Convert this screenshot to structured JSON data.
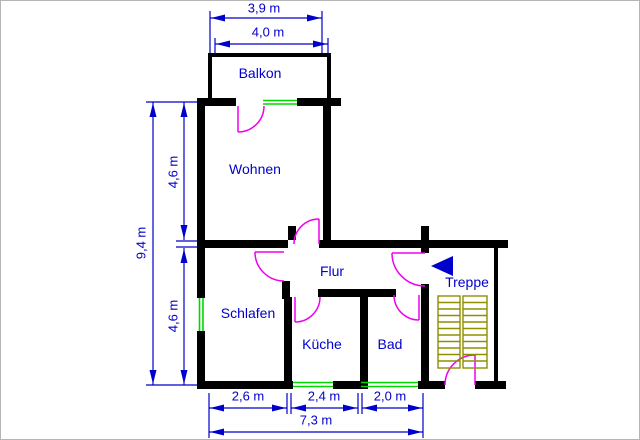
{
  "title": "Wohnungsgrundriss",
  "rooms": {
    "balcony": "Balkon",
    "living": "Wohnen",
    "hall": "Flur",
    "bedroom": "Schlafen",
    "kitchen": "Küche",
    "bath": "Bad",
    "stairs": "Treppe"
  },
  "dimensions": {
    "balcony_width": "3,9 m",
    "living_width": "4,0 m",
    "total_height": "9,4 m",
    "living_height": "4,6 m",
    "bedroom_height": "4,6 m",
    "bedroom_width": "2,6 m",
    "kitchen_width": "2,4 m",
    "bath_width": "2,0 m",
    "total_width": "7,3 m"
  },
  "icons": {
    "stairs_direction": "left-arrow"
  },
  "colors": {
    "wall": "#000000",
    "door": "#EE00EE",
    "window": "#00D800",
    "dimension": "#0000CC",
    "stairs": "#8F8F00",
    "background": "#FFFFFF"
  }
}
